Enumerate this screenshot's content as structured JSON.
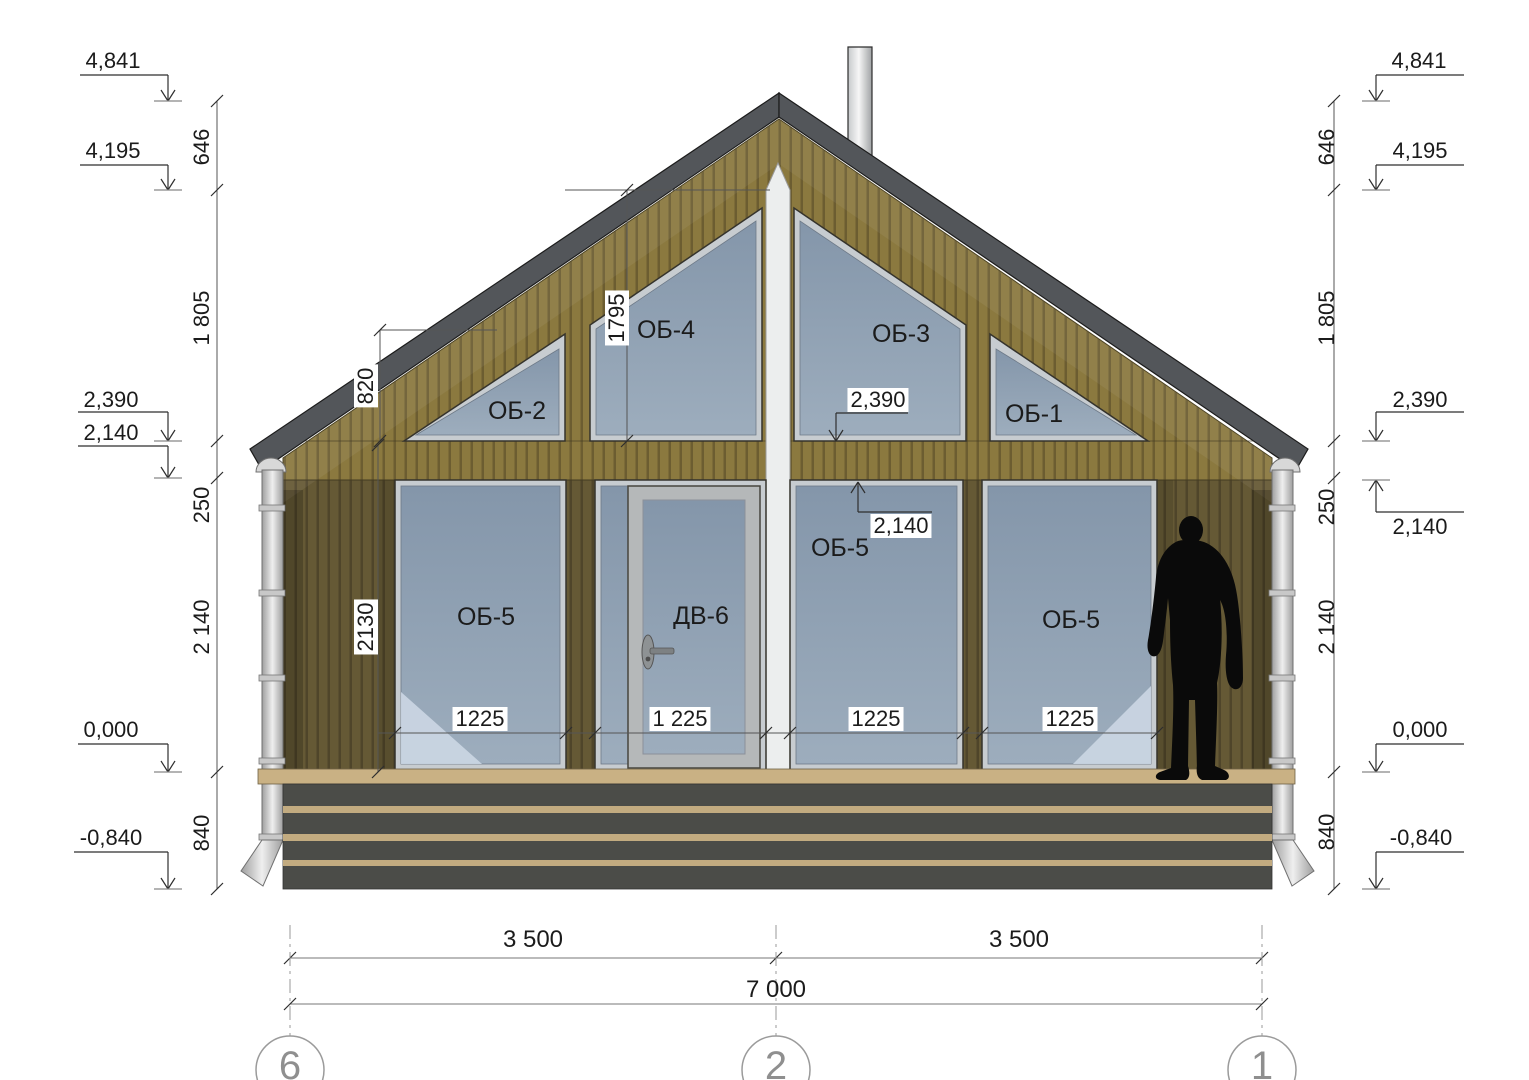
{
  "levels": {
    "l4841": "4,841",
    "l4195": "4,195",
    "l2390": "2,390",
    "l2140": "2,140",
    "l0": "0,000",
    "lm840": "-0,840"
  },
  "vdims": {
    "v646": "646",
    "v1805": "1 805",
    "v250": "250",
    "v2140": "2 140",
    "v840": "840"
  },
  "inner_dims": {
    "d820": "820",
    "d1795": "1795",
    "d2130": "2130",
    "e2390": "2,390",
    "e2140": "2,140",
    "w1": "1225",
    "w2": "1 225",
    "w3": "1225",
    "w4": "1225"
  },
  "openings": {
    "ob1": "ОБ-1",
    "ob2": "ОБ-2",
    "ob3": "ОБ-3",
    "ob4": "ОБ-4",
    "ob5": "ОБ-5",
    "dv6": "ДВ-6"
  },
  "bottom_dims": {
    "left": "3 500",
    "right": "3 500",
    "total": "7 000"
  },
  "grid": {
    "g6": "6",
    "g2": "2",
    "g1": "1"
  },
  "palette": {
    "siding_light": "#8b793f",
    "siding_dark": "#655935",
    "roof_fascia": "#53565a",
    "glass": "#8d9fb3",
    "plinth": "#4b4c48",
    "plinth_strip": "#c2ab80",
    "deck": "#c9b184",
    "pipe": "#d9d9d9",
    "annotation": "#2e2e2e",
    "grid_gray": "#8f8f8f"
  }
}
